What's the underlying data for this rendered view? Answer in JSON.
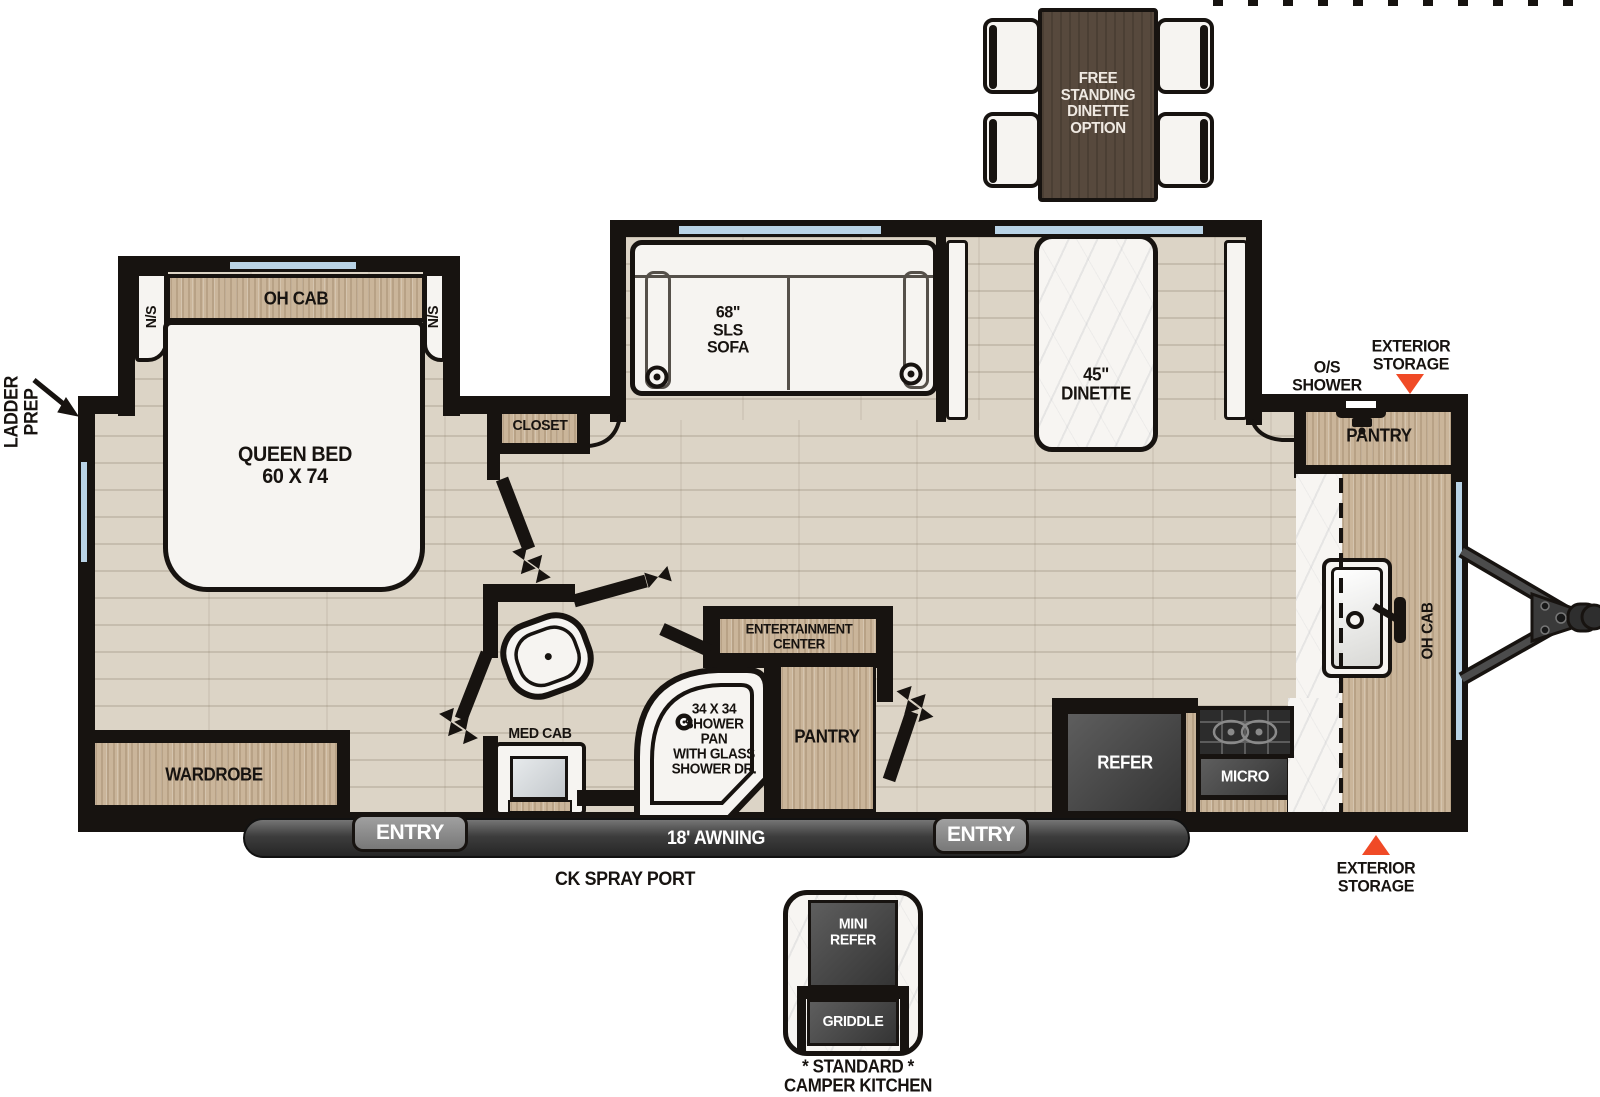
{
  "floorplan": {
    "labels": {
      "ladder_prep": "LADDER\nPREP",
      "oh_cab_bed": "OH CAB",
      "ns_left": "N/S",
      "ns_right": "N/S",
      "queen_bed": "QUEEN BED\n60 X 74",
      "closet": "CLOSET",
      "sofa": "68\"\nSLS\nSOFA",
      "dinette": "45\"\nDINETTE",
      "free_standing_option": "FREE\nSTANDING\nDINETTE\nOPTION",
      "exterior_storage_top": "EXTERIOR\nSTORAGE",
      "os_shower": "O/S\nSHOWER",
      "pantry_front": "PANTRY",
      "oh_cab_kitchen": "OH CAB",
      "wardrobe": "WARDROBE",
      "med_cab": "MED CAB",
      "shower_pan": "34 X 34\nSHOWER\nPAN\nWITH GLASS\nSHOWER DR.",
      "entertainment_center": "ENTERTAINMENT\nCENTER",
      "pantry_mid": "PANTRY",
      "refer": "REFER",
      "micro": "MICRO",
      "entry_left": "ENTRY",
      "entry_right": "ENTRY",
      "awning": "18' AWNING",
      "ck_spray_port": "CK SPRAY PORT",
      "exterior_storage_bottom": "EXTERIOR\nSTORAGE",
      "mini_refer": "MINI\nREFER",
      "griddle": "GRIDDLE",
      "camper_kitchen_caption": "* STANDARD *\nCAMPER KITCHEN"
    },
    "colors": {
      "wall": "#171310",
      "wood": "#cab59a",
      "floor": "#dcd4c6",
      "window_blue": "#b9d3e6",
      "accent_red": "#f04a26",
      "appliance_dark": "#3f3f3f",
      "table_brown": "#57493d",
      "marble_white": "#f7f5f2"
    }
  }
}
